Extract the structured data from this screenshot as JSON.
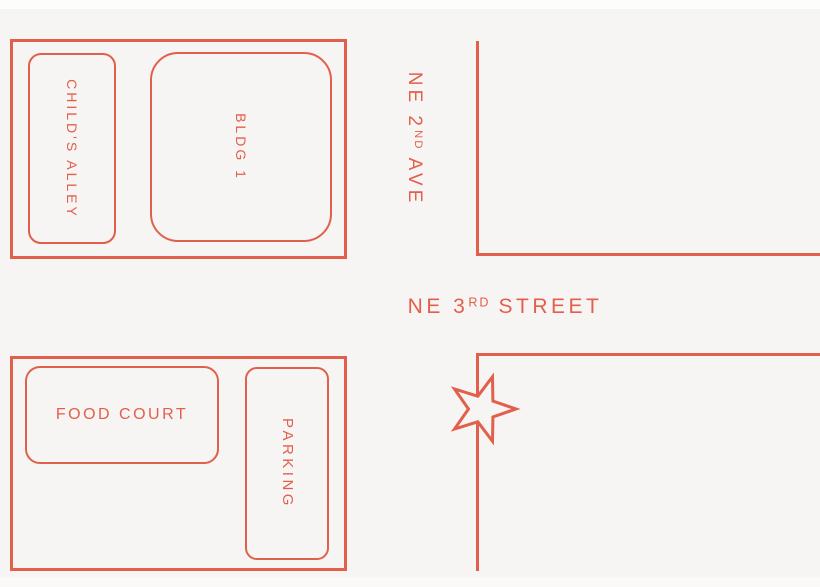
{
  "colors": {
    "accent": "#E2604B",
    "background": "#F6F5F4"
  },
  "blocks": {
    "north": {
      "childs_alley": "CHILD'S ALLEY",
      "bldg_1": "BLDG 1"
    },
    "south": {
      "food_court": "FOOD COURT",
      "parking": "PARKING"
    }
  },
  "streets": {
    "ne_2nd_ave": {
      "base": "NE 2",
      "ordinal": "ND",
      "rest": "AVE"
    },
    "ne_3rd_street": {
      "base": "NE 3",
      "ordinal": "RD",
      "rest": "STREET"
    }
  },
  "marker": {
    "icon": "star-icon"
  }
}
